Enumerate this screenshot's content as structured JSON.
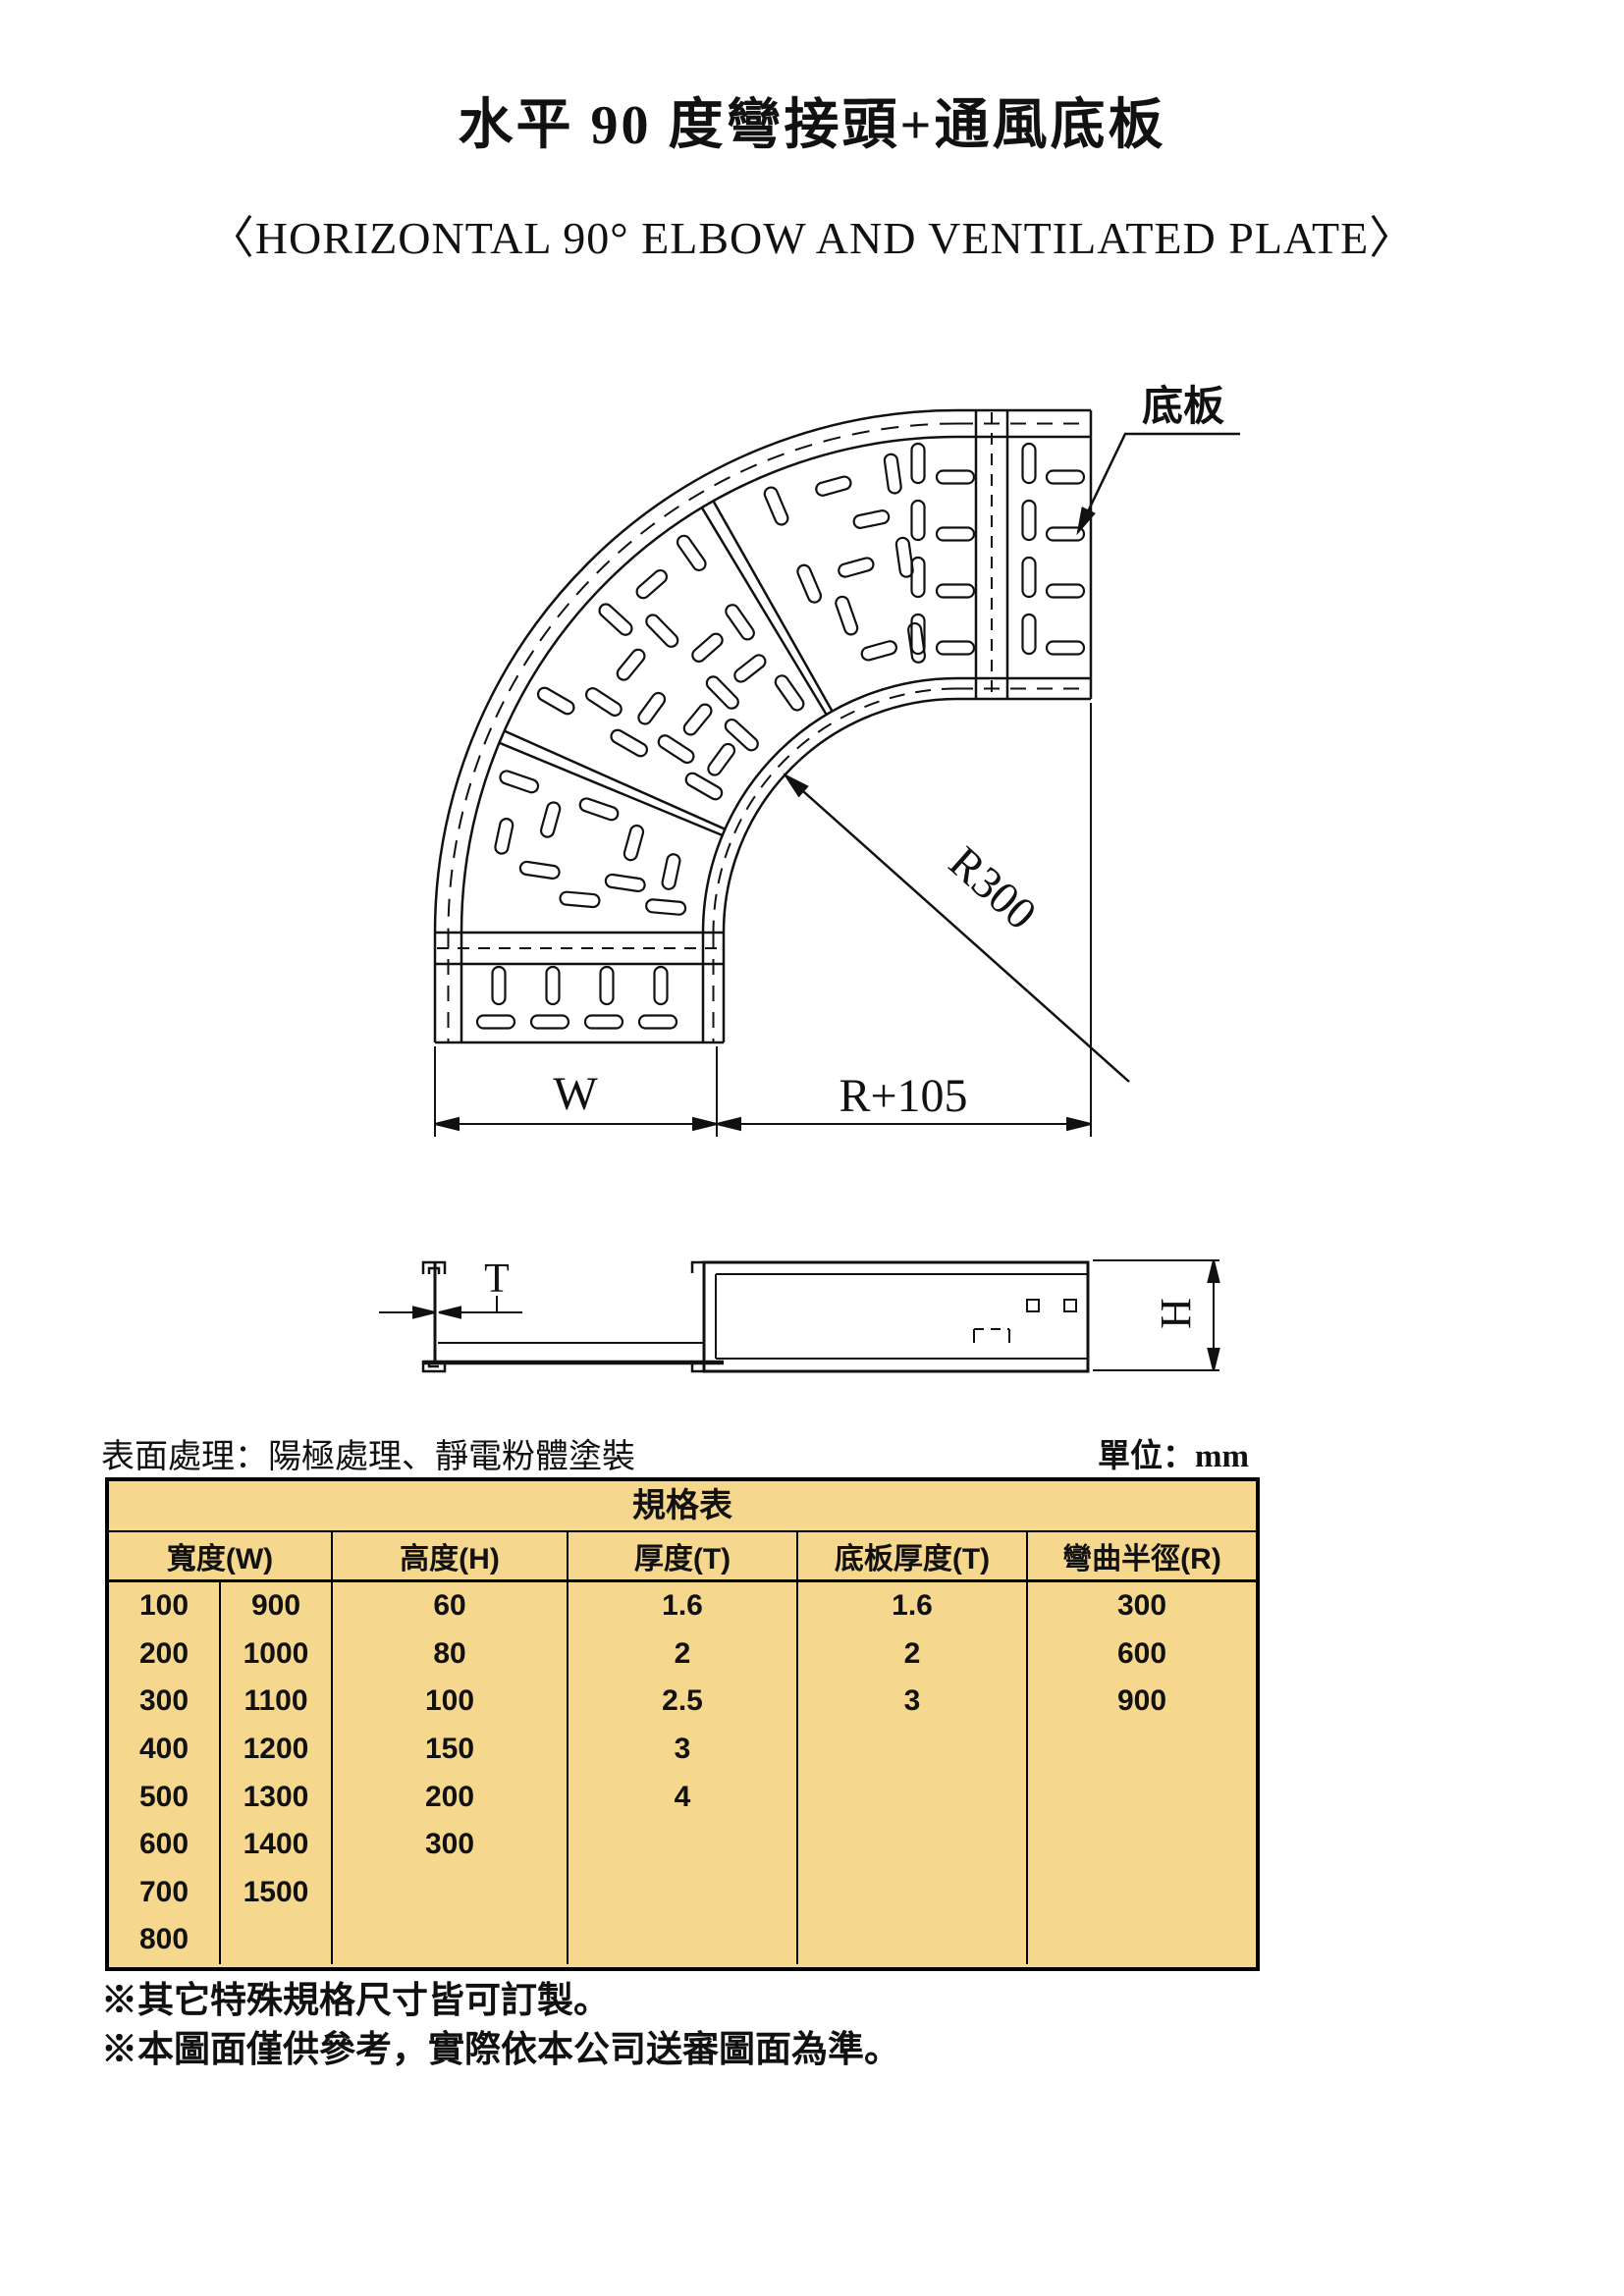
{
  "title": "水平 90 度彎接頭+通風底板",
  "subtitle": "〈HORIZONTAL 90° ELBOW AND VENTILATED PLATE〉",
  "drawing": {
    "plate_label": "底板",
    "radius_label": "R300",
    "width_label": "W",
    "r_plus_label": "R+105",
    "thickness_label": "T",
    "height_label": "H"
  },
  "surface_note": "表面處理：陽極處理、靜電粉體塗裝",
  "unit_note": "單位：mm",
  "table": {
    "caption": "規格表",
    "headers": [
      "寬度(W)",
      "高度(H)",
      "厚度(T)",
      "底板厚度(T)",
      "彎曲半徑(R)"
    ],
    "columns": {
      "w1": [
        "100",
        "200",
        "300",
        "400",
        "500",
        "600",
        "700",
        "800"
      ],
      "w2": [
        "900",
        "1000",
        "1100",
        "1200",
        "1300",
        "1400",
        "1500",
        ""
      ],
      "h": [
        "60",
        "80",
        "100",
        "150",
        "200",
        "300",
        "",
        ""
      ],
      "t": [
        "1.6",
        "2",
        "2.5",
        "3",
        "4",
        "",
        "",
        ""
      ],
      "pt": [
        "1.6",
        "2",
        "3",
        "",
        "",
        "",
        "",
        ""
      ],
      "r": [
        "300",
        "600",
        "900",
        "",
        "",
        "",
        "",
        ""
      ]
    }
  },
  "notes": [
    "※其它特殊規格尺寸皆可訂製。",
    "※本圖面僅供參考，實際依本公司送審圖面為準。"
  ],
  "colors": {
    "table_fill": "#F5D78E",
    "line": "#111111"
  }
}
